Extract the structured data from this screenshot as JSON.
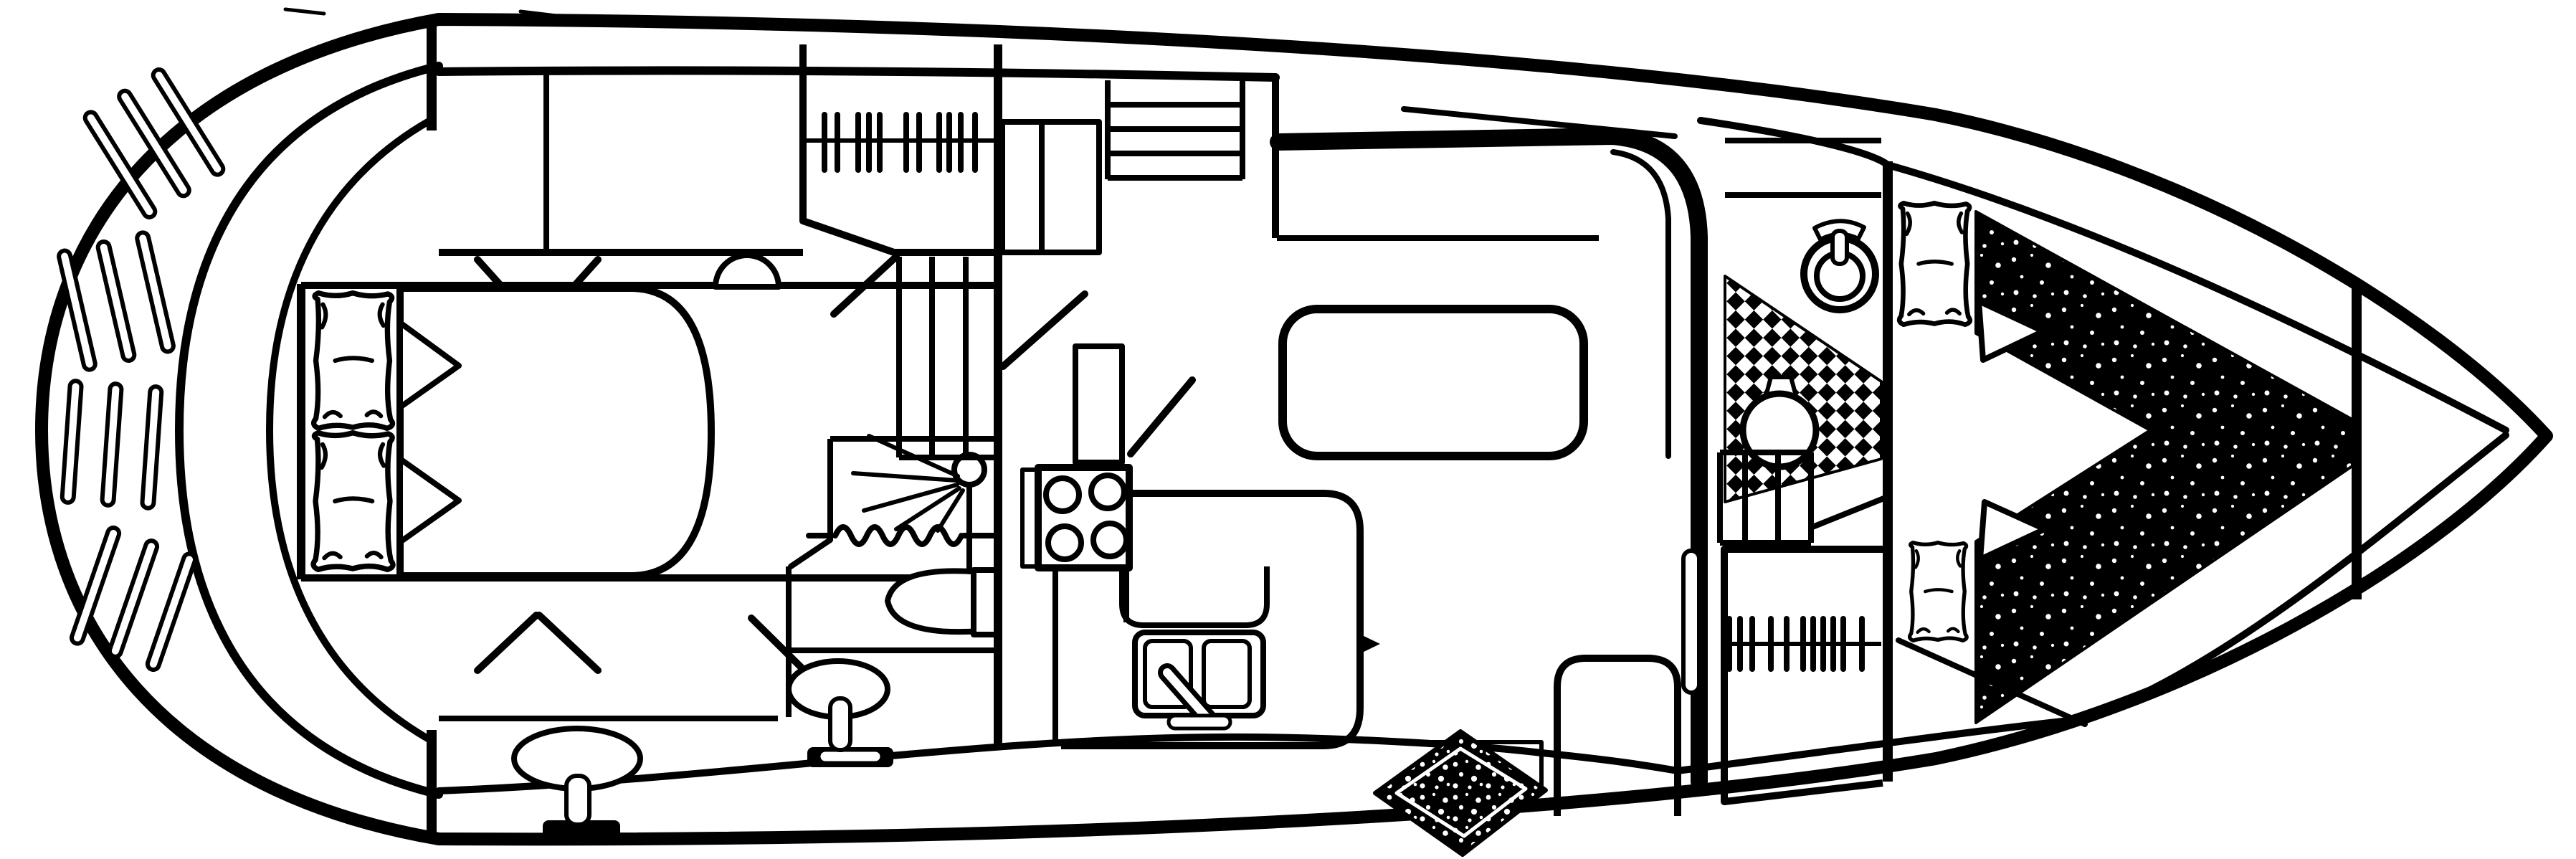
{
  "meta": {
    "description": "Black-and-white yacht interior floor plan line drawing, bow pointing right, stern swim platform at left"
  },
  "colors": {
    "ink": "#000000",
    "paper": "#ffffff"
  },
  "counts": {
    "swim_platform_slat_groups": 4,
    "slats_per_group": 3,
    "aft_berth_pillows": 2,
    "aft_hanger_ticks": 11,
    "mid_companionway_treads": 4,
    "mid_steps": 3,
    "stove_burners": 4,
    "galley_sink_bowls": 2,
    "fwd_steps": 3,
    "fwd_hanger_ticks": 11,
    "v_berth_pillows": 2
  },
  "features": [
    {
      "name": "hull-outline"
    },
    {
      "name": "swim-platform"
    },
    {
      "name": "transom"
    },
    {
      "name": "aft-cabin-double-berth"
    },
    {
      "name": "aft-pillows"
    },
    {
      "name": "aft-hanging-locker"
    },
    {
      "name": "clothes-hangers"
    },
    {
      "name": "vanity-sink"
    },
    {
      "name": "corner-stool"
    },
    {
      "name": "door-swing-lines"
    },
    {
      "name": "shower-stall"
    },
    {
      "name": "shower-head-spray"
    },
    {
      "name": "shower-curtain"
    },
    {
      "name": "toilet"
    },
    {
      "name": "pedestal-sink"
    },
    {
      "name": "companionway-steps"
    },
    {
      "name": "galley-stove"
    },
    {
      "name": "galley-counter"
    },
    {
      "name": "galley-double-sink"
    },
    {
      "name": "salon-settee"
    },
    {
      "name": "salon-rug"
    },
    {
      "name": "salon-credenza"
    },
    {
      "name": "cabin-door-leaf"
    },
    {
      "name": "fwd-head-toilet"
    },
    {
      "name": "checkerboard-tile-floor"
    },
    {
      "name": "fwd-head-basin"
    },
    {
      "name": "fwd-steps"
    },
    {
      "name": "fwd-hanging-locker"
    },
    {
      "name": "v-berth-cushion"
    },
    {
      "name": "v-berth-pillows"
    },
    {
      "name": "bow-bulkhead"
    },
    {
      "name": "forepeak"
    }
  ]
}
